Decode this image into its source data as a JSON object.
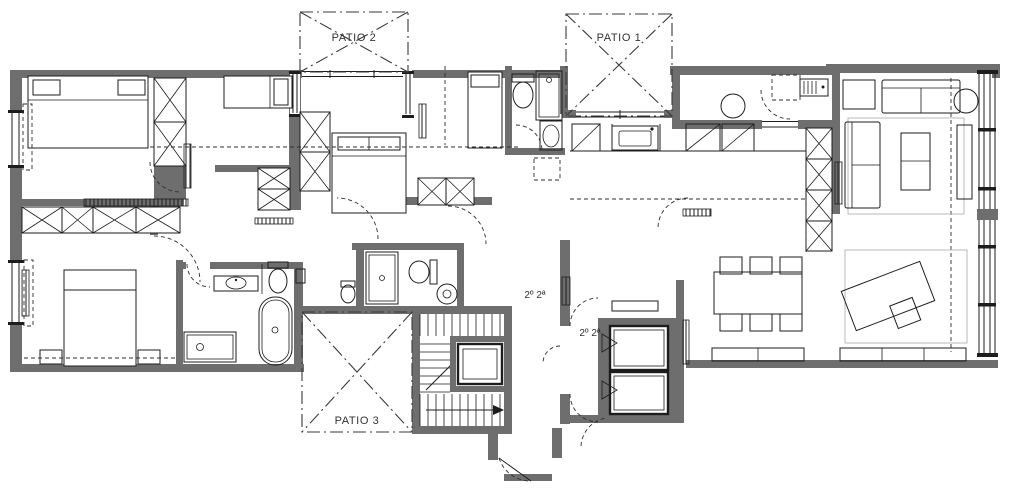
{
  "drawing": {
    "type": "architectural-floor-plan",
    "labels": {
      "patio_1": "PATIO 1",
      "patio_2": "PATIO 2",
      "patio_3": "PATIO 3",
      "unit_label_stair": "2º 2ª",
      "unit_label_lobby": "2º 2ª"
    },
    "colors": {
      "background": "#ffffff",
      "wall": "#6e6e6e",
      "line": "#1d1d1d",
      "light_line": "#b9b9b9",
      "text": "#333333"
    }
  }
}
